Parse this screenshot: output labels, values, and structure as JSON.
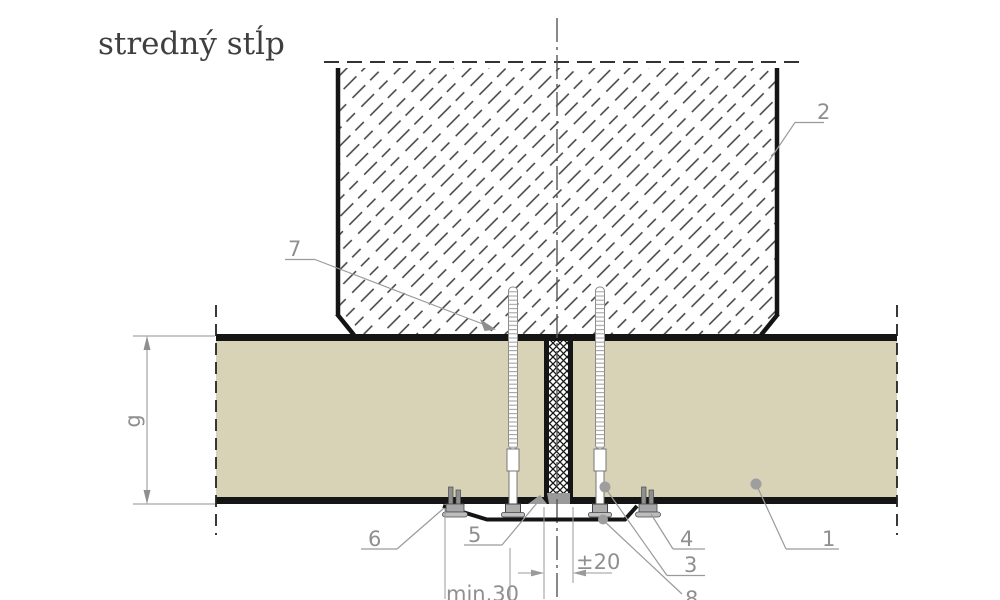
{
  "title": "stredný stĺp",
  "part_numbers": {
    "p1": "1",
    "p2": "2",
    "p3": "3",
    "p4": "4",
    "p5": "5",
    "p6": "6",
    "p7": "7",
    "p8": "8"
  },
  "dimensions": {
    "panel_thickness": "g",
    "joint_tolerance": "±20",
    "min_edge_distance": "min.30"
  },
  "colors": {
    "panel_fill": "#d8d2b6",
    "outline_black": "#151515",
    "annotation_gray": "#8f8f8f",
    "hatch_gray": "#3d3d3d",
    "sealant_gray": "#9a9a9a"
  }
}
